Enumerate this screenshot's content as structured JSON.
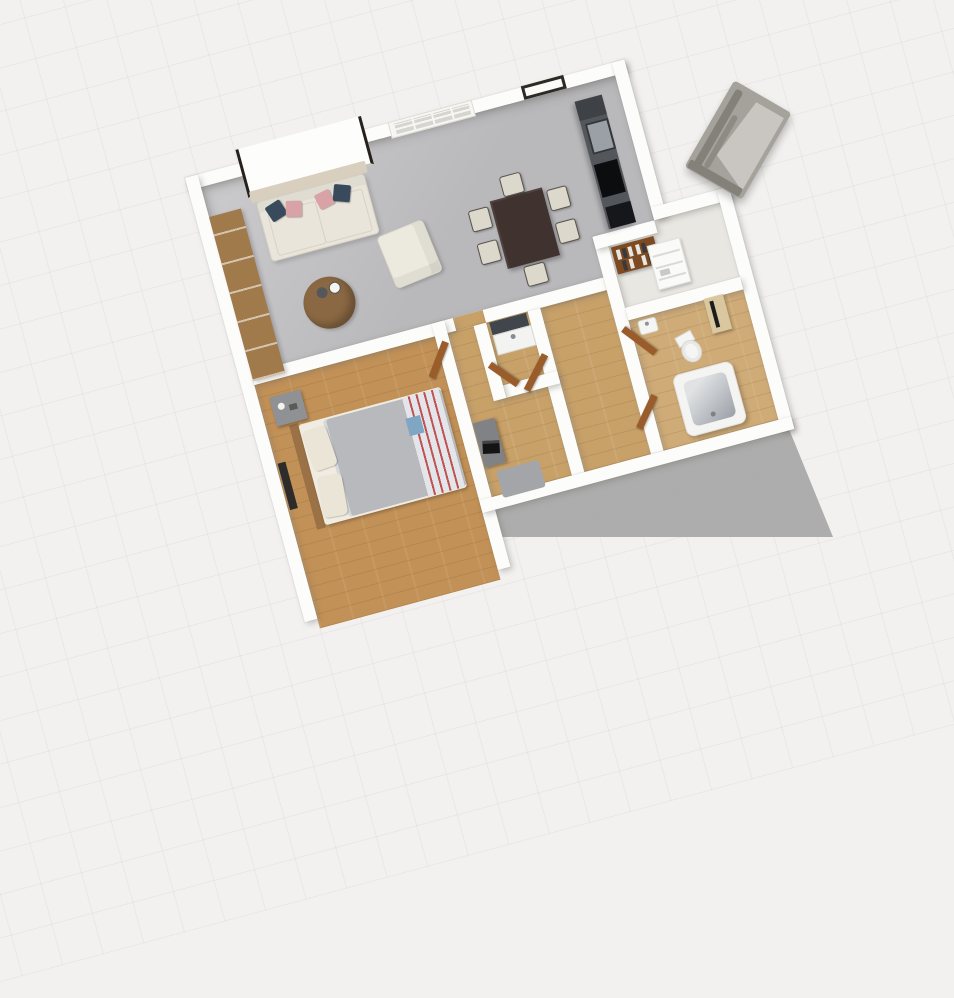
{
  "scene": {
    "type": "3d-floorplan-render",
    "description": "Overhead 3D render of a one-bedroom apartment, plan rotated about 15 degrees counter-clockwise on a faint grid background. Open living/dining/kitchen with gray floor; bedroom, hallway, WC, closet and bathroom with wood floors; gray decorative stone object floating outside the walls; building ground-shadow at lower right.",
    "rooms": [
      {
        "id": "living-room",
        "contents": [
          "leaning canvas",
          "console table",
          "sofa with pillows",
          "sideboard shelving",
          "round coffee table",
          "armchair"
        ]
      },
      {
        "id": "dining-area",
        "contents": [
          "dark dining table",
          "six cream chairs"
        ]
      },
      {
        "id": "kitchen",
        "contents": [
          "counter run",
          "sink",
          "cooktop",
          "oven"
        ]
      },
      {
        "id": "bedroom",
        "contents": [
          "double bed",
          "nightstand",
          "radiator"
        ]
      },
      {
        "id": "hallway",
        "contents": [
          "desk",
          "laptop",
          "rug"
        ]
      },
      {
        "id": "wc",
        "contents": [
          "vanity with mirror"
        ]
      },
      {
        "id": "closet",
        "contents": [
          "bookshelf",
          "white shelving unit"
        ]
      },
      {
        "id": "bathroom",
        "contents": [
          "washbasin",
          "toilet",
          "tan cabinet",
          "bathtub"
        ]
      }
    ],
    "doors": 5,
    "windows": [
      "white multipane window",
      "dark framed window"
    ]
  },
  "colors": {
    "background": "#f2f1ef",
    "wall": "#fcfcfa",
    "ground_shadow": "#a5a5a5",
    "floor_living": "#b9b8bb",
    "floor_living_light": "#cbcacc",
    "floor_wood_bedroom": "#c29157",
    "floor_wood_hall": "#c8a169",
    "floor_wood_bath": "#cfab77",
    "floor_closet": "#e9e7e2",
    "sofa": "#e9e5da",
    "sofa_edge": "#d8d2c4",
    "pillow_navy": "#394a5c",
    "pillow_pink": "#d9a2a7",
    "canvas": "#fdfdfc",
    "canvas_frame": "#26211d",
    "console_wood": "#d8cfbf",
    "sideboard_wood": "#a17a4b",
    "coffee_table_wood": "#8a6843",
    "bowl_dark": "#55585a",
    "cup_white": "#f4f4f2",
    "armchair": "#eceadf",
    "dining_table": "#40322e",
    "chair": "#dcd8cb",
    "chair_leg": "#59534d",
    "counter": "#53575c",
    "counter_dark_top": "#3e4246",
    "sink": "#9aa0a5",
    "sink_rim": "#33373b",
    "cooktop": "#0c0d0f",
    "oven": "#16171a",
    "window_frame_white": "#f7f6f2",
    "window_pane": "#d6d6d1",
    "window_frame_dark": "#2d2925",
    "window_pane_bright": "#fafaf9",
    "duvet": "#b7b9bc",
    "bed_mattress": "#f0ece2",
    "bed_pillow": "#eae5d6",
    "bed_frame": "#9b7246",
    "blanket": "#e2e6ea",
    "blanket_red": "#c25252",
    "blanket_blue": "#7fa6c2",
    "nightstand": "#8f9194",
    "radiator": "#2d2c2a",
    "mirror": "#41464c",
    "vanity": "#f3f3f1",
    "desk": "#808285",
    "laptop": "#141414",
    "rug": "#a3a5a8",
    "door": "#9a5c2a",
    "bookshelf": "#7d4a22",
    "book_light": "#e8e6e0",
    "book_dark": "#3a3a3a",
    "shelf_unit": "#fafaf8",
    "shelf_line": "#d9d9d5",
    "toilet": "#f5f5f3",
    "tub": "#f4f4f2",
    "tub_inner": "#e0e2e4",
    "tub_deep": "#9aa0a6",
    "basin": "#f5f5f3",
    "cabinet_tan": "#d9c7a0",
    "cabinet_screen": "#1c1c1c",
    "fireplace_body": "#a5a19b",
    "fireplace_light": "#c9c6c1",
    "fireplace_dark": "#84807a"
  }
}
